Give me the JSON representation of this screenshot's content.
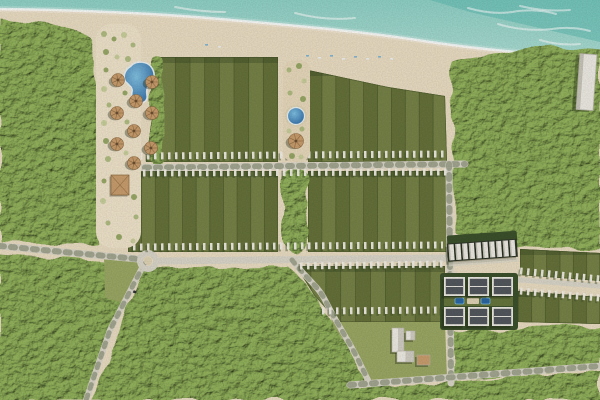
{
  "scene": {
    "type": "aerial-masterplan-render",
    "description": "Photorealistic top-down rendering of a beachfront residential lot development: turquoise sea and white-sand beach at top, jungle forest, striped green land lots, internal roads with a roundabout, a beach club with pool and palapas, a pocket park with round pool, a townhouse row, a condo cluster with courtyard pools, a clubhouse area, and a narrow beachfront building.",
    "visible_text": [],
    "lot_count_estimate": 62
  },
  "palette": {
    "sand": "#e9dcc2",
    "sand_light": "#eee2c9",
    "sand_path": "#e6d8ba",
    "water_shallow": "#aadcd2",
    "water_mid": "#8fd0c5",
    "water_deep": "#5fbcb2",
    "foam": "#ffffff",
    "forest_base": "#5d7a3c",
    "forest_light": "#8fae5a",
    "lawn": "#9aa763",
    "lawn_light": "#a6b06c",
    "lot_base": "#6c783e",
    "lot_dark": "#65713a",
    "lot_light": "#768247",
    "lot_divider": "#4d5a2d",
    "lot_shadow": "#2f401f",
    "road": "#d9d5c8",
    "road_shadow": "#3d4f28",
    "drive_white": "#f3f0e7",
    "pool_deep": "#2b66a2",
    "pool_light": "#7fc0e2",
    "pool_deck": "#dfd3b4",
    "palapa": "#c89d6d",
    "palapa_spoke": "#8f6b42",
    "palapa_center": "#6b4f33",
    "roof_white": "#eceae2",
    "roof_gray": "#53585e",
    "trim": "#b9b5a9",
    "hedge": "#3c512c",
    "shadow": "rgba(25,35,15,0.35)"
  },
  "ocean": {
    "shore_d": "M0,9 C80,10 150,13 220,19 C300,26 360,31 430,42 C500,52 560,56 600,58",
    "deep_pts": "430,0 600,0 600,42 470,12",
    "streaks": [
      "M468,8 Q492,15 512,12 Q536,8 556,14",
      "M498,24 Q524,32 552,29 Q572,26 590,31",
      "M540,40 Q560,46 580,44",
      "M295,13 Q325,21 355,18",
      "M175,7 Q200,12 225,12",
      "M520,6 Q545,12 570,10"
    ]
  },
  "forests": [
    {
      "name": "west-forest",
      "pts": "0,20 66,25 94,42 98,160 98,244 0,242"
    },
    {
      "name": "southwest-forest",
      "pts": "0,254 140,264 86,400 0,400"
    },
    {
      "name": "south-central-forest",
      "pts": "146,268 290,265 314,296 334,324 356,360 368,382 350,400 92,400"
    },
    {
      "name": "south-strip-forest",
      "pts": "346,400 358,388 600,371 600,400"
    },
    {
      "name": "southeast-forest",
      "pts": "452,330 600,326 600,368 466,379 452,381"
    },
    {
      "name": "east-forest",
      "pts": "452,62 540,45 600,50 600,250 520,246 455,236"
    }
  ],
  "hedges": [
    {
      "name": "central-median-hedge",
      "x": 282,
      "y": 168,
      "w": 26,
      "h": 86,
      "rx": 13
    },
    {
      "name": "beachclub-hedge",
      "x": 150,
      "y": 56,
      "w": 13,
      "h": 107,
      "rx": 6
    }
  ],
  "lawns": [
    {
      "name": "west-clearing",
      "pts": "104,257 141,261 139,276 124,303 105,298",
      "car": [
        133,
        290
      ]
    },
    {
      "name": "clubhouse-lawn",
      "pts": "330,314 445,322 447,378 370,380 350,348 334,328"
    }
  ],
  "lot_blocks": [
    {
      "name": "beachfront-west",
      "pts": "160,57 278,57 278,162 146,162",
      "stripes": 9
    },
    {
      "name": "beachfront-east",
      "pts": "308,70 388,87 445,96 447,162 308,162",
      "stripes": 10
    },
    {
      "name": "central-west",
      "pts": "128,171 278,171 278,252 128,252",
      "stripes": 11
    },
    {
      "name": "central-east",
      "pts": "308,171 447,171 447,252 308,252",
      "stripes": 10
    },
    {
      "name": "south-block",
      "pts": "296,266 445,266 445,322 338,322 314,295",
      "stripes": 10
    },
    {
      "name": "east-north-block",
      "pts": "520,249 600,253 600,281 520,275",
      "stripes": 6
    },
    {
      "name": "east-south-block",
      "pts": "518,291 600,297 600,324 518,322",
      "stripes": 6
    }
  ],
  "roads": [
    {
      "name": "beach-road",
      "d": "M112,168 L465,164",
      "w": 7,
      "shadow": true
    },
    {
      "name": "main-avenue-west",
      "d": "M0,246 L138,259",
      "w": 7,
      "shadow": true
    },
    {
      "name": "main-avenue",
      "d": "M158,261 L447,258",
      "w": 7,
      "shadow": false
    },
    {
      "name": "entry-lane",
      "d": "M144,264 L110,330 L86,400",
      "w": 6,
      "shadow": true
    },
    {
      "name": "east-road",
      "d": "M449,164 L451,383",
      "w": 7,
      "shadow": true
    },
    {
      "name": "south-curve-road",
      "d": "M292,260 C306,278 318,286 325,300 C333,316 336,320 345,336 C355,352 360,364 368,380",
      "w": 6,
      "shadow": true
    },
    {
      "name": "coastal-south-road",
      "d": "M350,385 L600,366",
      "w": 7,
      "shadow": true
    },
    {
      "name": "east-lots-lane",
      "d": "M452,275 L600,286",
      "w": 5,
      "shadow": false
    }
  ],
  "roundabout": {
    "cx": 148,
    "cy": 261,
    "r": 8
  },
  "driveways": [
    [
      140,
      156,
      445,
      154
    ],
    [
      129,
      173,
      447,
      172
    ],
    [
      133,
      247,
      443,
      245
    ],
    [
      300,
      266,
      443,
      264
    ],
    [
      322,
      311,
      443,
      310
    ],
    [
      520,
      271,
      600,
      279
    ],
    [
      520,
      291,
      600,
      298
    ]
  ],
  "beach_club": {
    "strip": {
      "x": 96,
      "y": 24,
      "w": 45,
      "h": 224,
      "rx": 16
    },
    "pool_d": "M131,66 C136,60 148,61 152,68 C156,75 154,80 150,84 C147,87 146,90 147,95 C148,101 143,104 138,103 C132,102 131,97 132,92 C133,88 130,86 127,83 C122,79 124,70 131,66 Z",
    "palapas": [
      [
        118,
        80
      ],
      [
        152,
        82
      ],
      [
        136,
        101
      ],
      [
        117,
        113
      ],
      [
        152,
        113
      ],
      [
        134,
        131
      ],
      [
        117,
        144
      ],
      [
        151,
        148
      ],
      [
        134,
        163
      ]
    ],
    "palapa_r": 6.5,
    "pavilion": {
      "x": 111,
      "y": 175,
      "w": 18,
      "h": 20
    },
    "shrub_colors": [
      "#a9b87a",
      "#8ea25c",
      "#c3cc96"
    ],
    "shrubs": [
      [
        104,
        34,
        3,
        0
      ],
      [
        114,
        39,
        2.5,
        1
      ],
      [
        124,
        35,
        3,
        2
      ],
      [
        133,
        45,
        2.5,
        0
      ],
      [
        106,
        52,
        3,
        1
      ],
      [
        117,
        57,
        2.5,
        2
      ],
      [
        128,
        59,
        3,
        0
      ],
      [
        106,
        70,
        2.5,
        1
      ],
      [
        104,
        89,
        3,
        2
      ],
      [
        109,
        105,
        2.5,
        0
      ],
      [
        125,
        93,
        2.5,
        1
      ],
      [
        104,
        123,
        3,
        2
      ],
      [
        127,
        122,
        2.5,
        0
      ],
      [
        106,
        141,
        3,
        1
      ],
      [
        126,
        153,
        2.5,
        2
      ],
      [
        108,
        159,
        3,
        0
      ],
      [
        104,
        181,
        2.5,
        1
      ],
      [
        103,
        201,
        3,
        2
      ],
      [
        108,
        223,
        2.5,
        0
      ],
      [
        119,
        237,
        3,
        1
      ],
      [
        133,
        241,
        2.5,
        2
      ],
      [
        136,
        217,
        2.5,
        0
      ],
      [
        134,
        197,
        3,
        1
      ]
    ]
  },
  "pocket_park": {
    "strip": {
      "x": 283,
      "y": 60,
      "w": 27,
      "h": 102,
      "rx": 11
    },
    "pool": {
      "cx": 296,
      "cy": 116,
      "r": 8.5
    },
    "palapa": [
      296,
      141
    ],
    "palapa_r": 7.5,
    "shrubs": [
      [
        289,
        70,
        2.5,
        0
      ],
      [
        299,
        66,
        3,
        1
      ],
      [
        304,
        81,
        2.5,
        2
      ],
      [
        290,
        93,
        2.5,
        0
      ],
      [
        303,
        99,
        3,
        1
      ],
      [
        289,
        131,
        2.5,
        2
      ],
      [
        302,
        129,
        2.5,
        0
      ],
      [
        292,
        156,
        3,
        1
      ],
      [
        301,
        157,
        2.5,
        2
      ]
    ]
  },
  "townhouses": {
    "x": 449,
    "y": 242,
    "count": 10,
    "unit_w": 5.2,
    "gap": 1.6,
    "unit_h": 16,
    "tilt": -4,
    "pivot": [
      485,
      252
    ],
    "yard": {
      "x": 448,
      "y": 233,
      "w": 70,
      "h": 10
    },
    "front": {
      "x": 448,
      "y": 260,
      "w": 70,
      "h": 4
    }
  },
  "condos": {
    "x": 444,
    "y": 277,
    "cols": 3,
    "rows": 2,
    "w": 21,
    "h": 19,
    "gx": 24,
    "gy": 30,
    "hedge": {
      "x": 440,
      "y": 273,
      "w": 78,
      "h": 57
    },
    "court": {
      "x": 444,
      "y": 297,
      "w": 69,
      "h": 9
    },
    "pools": [
      [
        455,
        298
      ],
      [
        481,
        298
      ]
    ],
    "deck": [
      467,
      298,
      12,
      6
    ]
  },
  "clubhouse": {
    "buildings": [
      {
        "x": 392,
        "y": 328,
        "w": 12,
        "h": 24,
        "t": "w"
      },
      {
        "x": 406,
        "y": 331,
        "w": 9,
        "h": 9,
        "t": "w"
      },
      {
        "x": 397,
        "y": 351,
        "w": 17,
        "h": 11,
        "t": "w"
      },
      {
        "x": 417,
        "y": 355,
        "w": 13,
        "h": 10,
        "t": "t"
      }
    ]
  },
  "beach_building": {
    "x": 578,
    "y": 54,
    "w": 17,
    "h": 56,
    "rot": 4,
    "cx": 586,
    "cy": 82
  },
  "loungers": [
    [
      306,
      55
    ],
    [
      318,
      57
    ],
    [
      330,
      55
    ],
    [
      342,
      58
    ],
    [
      354,
      56
    ],
    [
      366,
      58
    ],
    [
      378,
      56
    ],
    [
      390,
      58
    ],
    [
      205,
      44
    ],
    [
      218,
      46
    ]
  ]
}
